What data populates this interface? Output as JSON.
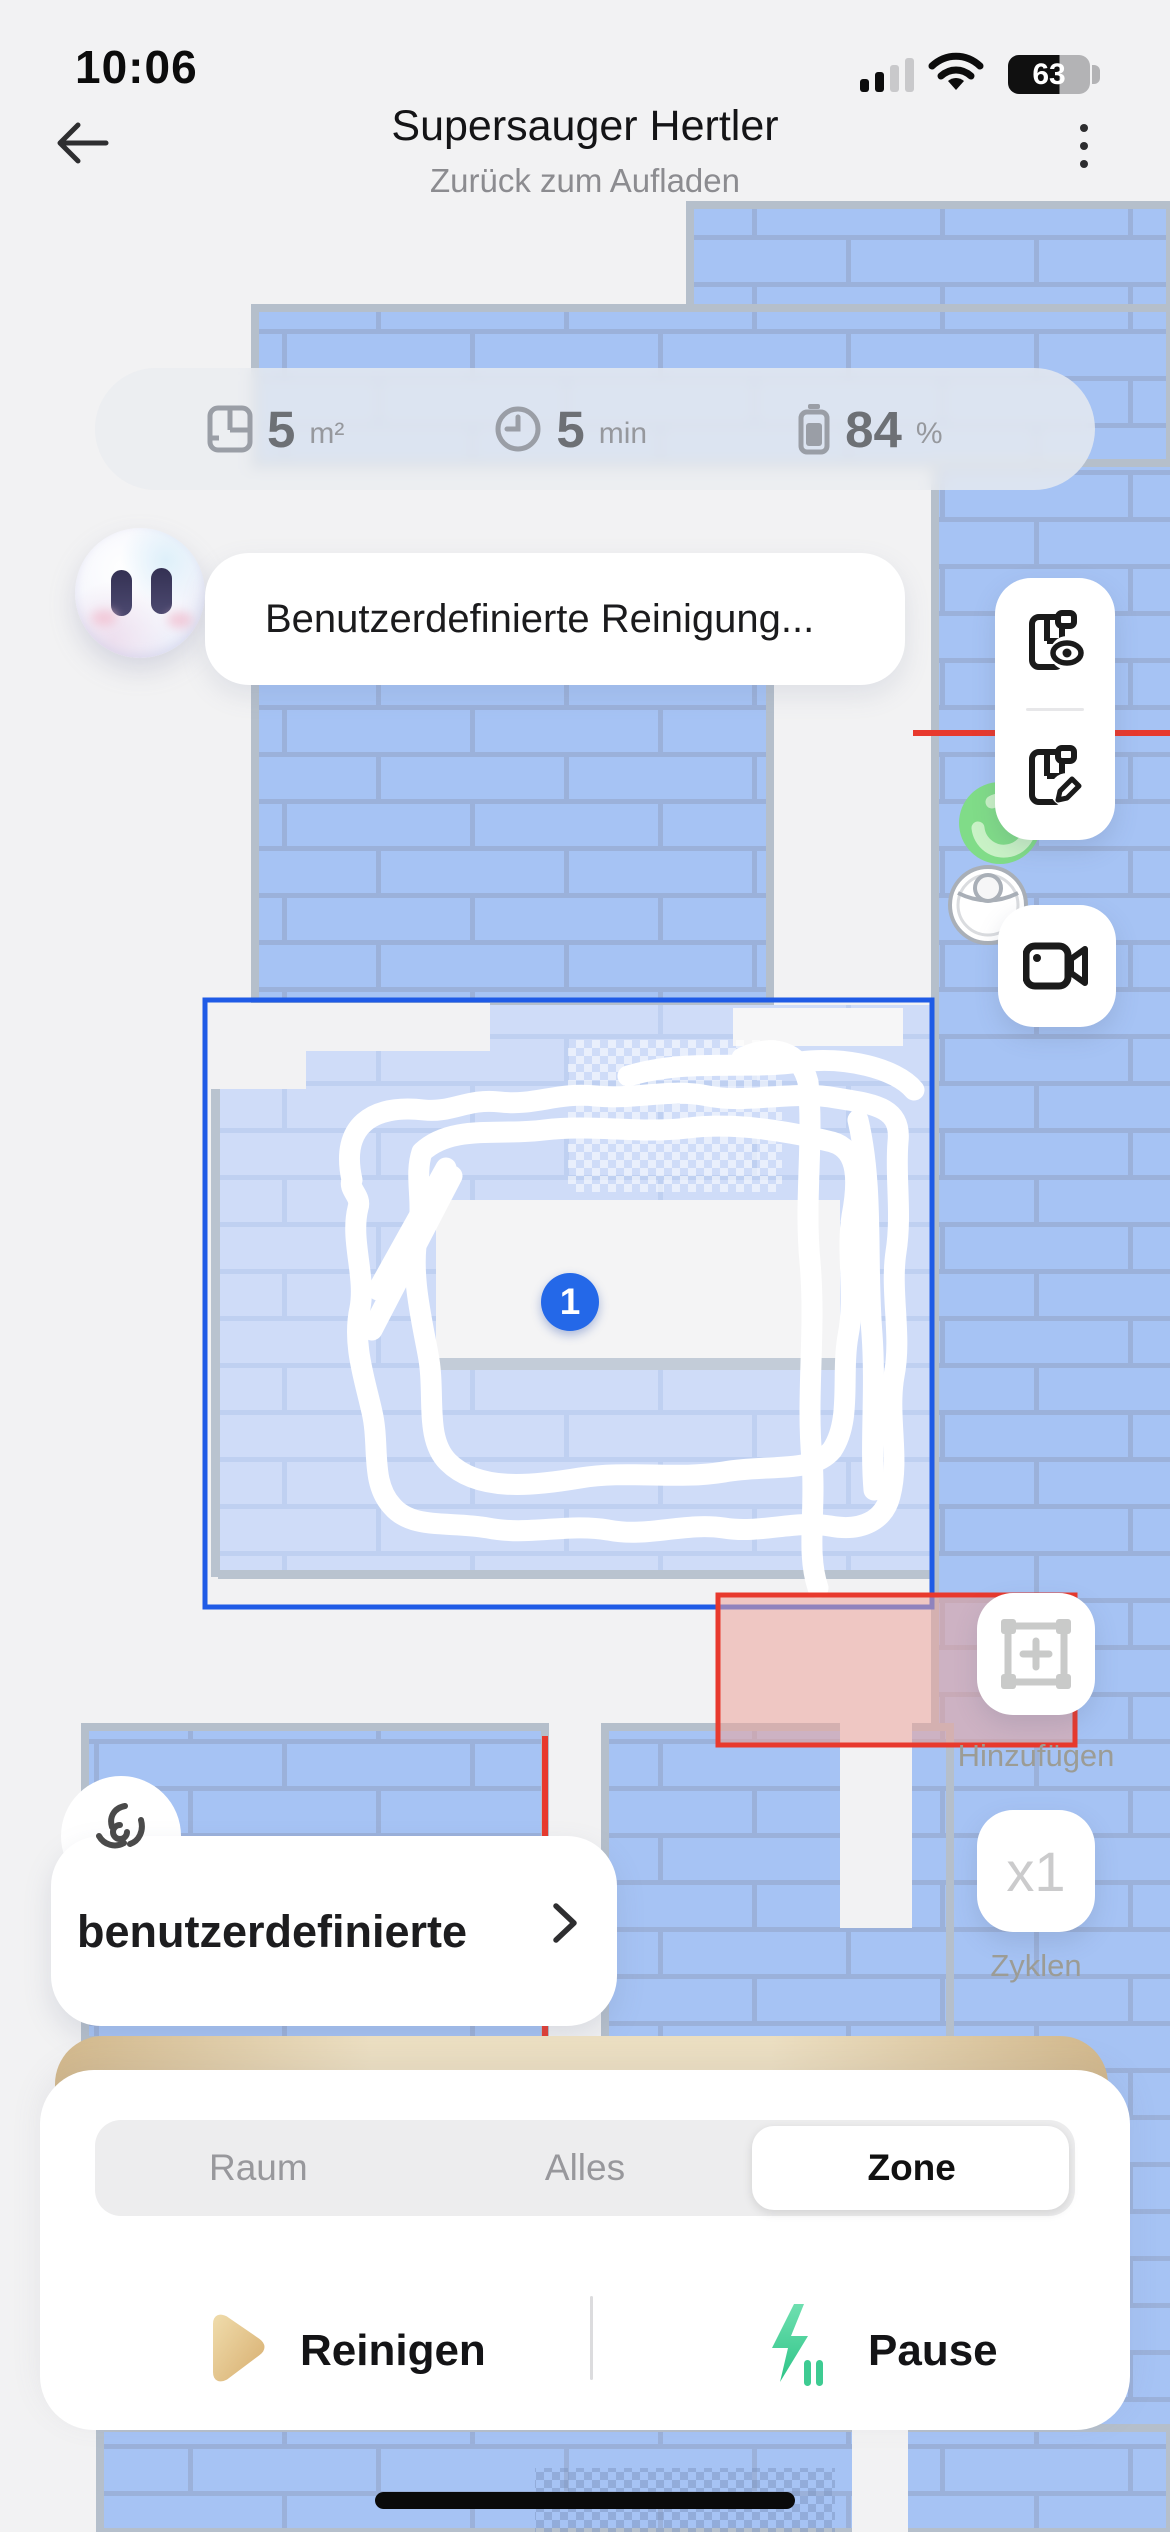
{
  "status_bar": {
    "time": "10:06",
    "battery_level": "63"
  },
  "header": {
    "back_icon": "arrow-left",
    "title": "Supersauger Hertler",
    "subtitle": "Zurück zum Aufladen",
    "menu_icon": "kebab-menu"
  },
  "stats": [
    {
      "icon": "floor-area-icon",
      "value": "5",
      "unit": "m²"
    },
    {
      "icon": "clock-icon",
      "value": "5",
      "unit": "min"
    },
    {
      "icon": "battery-icon",
      "value": "84",
      "unit": "%"
    }
  ],
  "assistant": {
    "avatar": "robot-face",
    "message": "Benutzerdefinierte Reinigung..."
  },
  "map": {
    "zone_badge": "1"
  },
  "side_controls": {
    "map_view_icon": "map-eye",
    "map_edit_icon": "map-pencil",
    "camera_icon": "video-camera",
    "add_label": "Hinzufügen",
    "cycles_value": "x1",
    "cycles_label": "Zyklen"
  },
  "mode_button": {
    "icon": "fan-icon",
    "label": "benutzerdefinierte"
  },
  "bottom_sheet": {
    "tabs": [
      {
        "label": "Raum",
        "selected": false
      },
      {
        "label": "Alles",
        "selected": false
      },
      {
        "label": "Zone",
        "selected": true
      }
    ],
    "clean_label": "Reinigen",
    "pause_label": "Pause"
  },
  "colors": {
    "accent_blue": "#2160e8",
    "map_blue": "#a6c3f4",
    "map_blue_light": "#cfdcf8",
    "nogo_red": "#e8392d",
    "tan": "#d2b88c",
    "pause_green": "#3ecb92",
    "badge_blue": "#2468e8"
  }
}
